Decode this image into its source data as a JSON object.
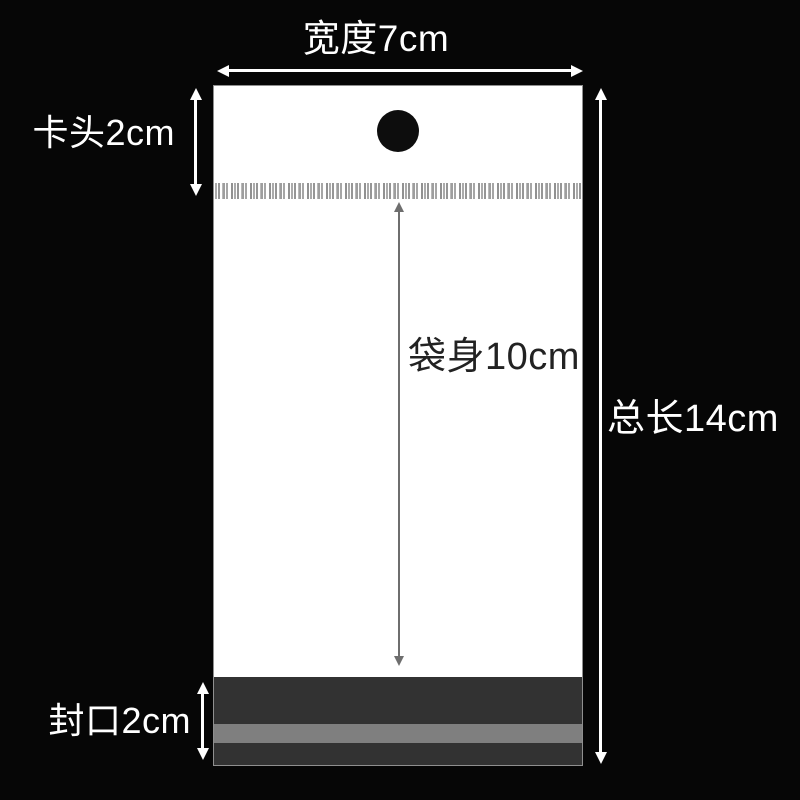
{
  "labels": {
    "width": "宽度7cm",
    "header": "卡头2cm",
    "body": "袋身10cm",
    "total_length": "总长14cm",
    "seal": "封口2cm"
  },
  "measurements": {
    "width_cm": "7",
    "header_cm": "2",
    "body_cm": "10",
    "total_length_cm": "14",
    "seal_cm": "2"
  },
  "colors": {
    "background": "#060606",
    "bag": "#ffffff",
    "bag_edge": "#8f8f8f",
    "hole": "#0d0d0d",
    "seal_dark": "#323232",
    "seal_gray": "#7f7f7f",
    "arrow_light": "#ffffff",
    "arrow_dark": "#6e6e6e",
    "label_light": "#ffffff",
    "label_dark": "#222222"
  }
}
